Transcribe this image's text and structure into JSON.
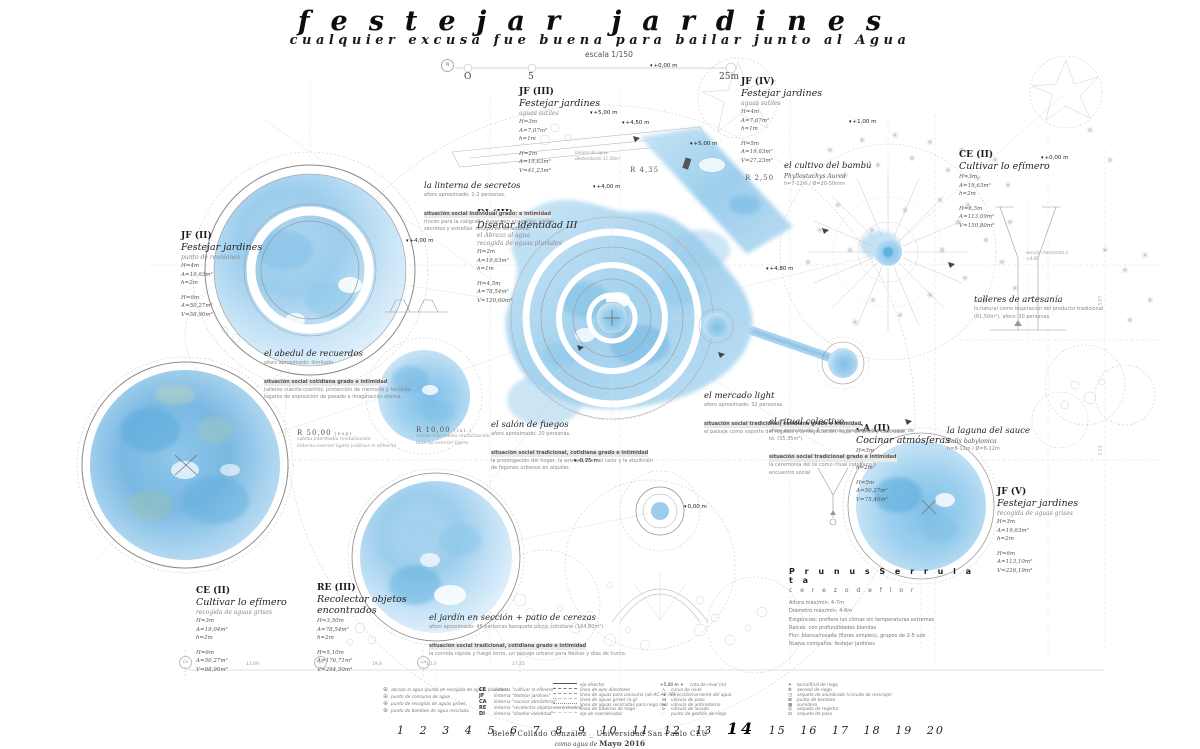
{
  "glyphs": {
    "level": "▾",
    "plant": "✳",
    "north": "N",
    "circle_plus": "⊕"
  },
  "header": {
    "title": "festejar jardines",
    "subtitle": "cualquier excusa fue buena para bailar junto al Agua",
    "scale_label": "escala 1/150",
    "scale_ticks": [
      "O",
      "5",
      "25m"
    ]
  },
  "blocks": {
    "jf2": {
      "code": "JF (II)",
      "title": "Festejar jardines",
      "sub": "punto de reuniones",
      "stats1": [
        "H=4m",
        "A=19,63m²",
        "h=2m"
      ],
      "stats2": [
        "H=6m",
        "A=50,27m²",
        "V=58,90m³"
      ]
    },
    "jf3": {
      "code": "JF (III)",
      "title": "Festejar jardines",
      "sub": "aguas sutiles",
      "stats1": [
        "H=3m",
        "A=7,07m²",
        "h=1m"
      ],
      "stats2": [
        "H=2m",
        "A=19,63m²",
        "V=41,23m³"
      ],
      "note": "lámina de agua desbordante 31,50m²"
    },
    "jf4": {
      "code": "JF (IV)",
      "title": "Festejar jardines",
      "sub": "aguas sutiles",
      "stats1": [
        "H=4m",
        "A=7,07m²",
        "h=1m"
      ],
      "stats2": [
        "H=5m",
        "A=19,63m²",
        "V=27,23m³"
      ]
    },
    "jf5": {
      "code": "JF (V)",
      "title": "Festejar jardines",
      "sub": "recogida de aguas grises",
      "stats1": [
        "H=3m",
        "A=19,63m²",
        "h=2m"
      ],
      "stats2": [
        "H=6m",
        "A=113,10m²",
        "V=226,19m³"
      ]
    },
    "ce2_top": {
      "code": "CE (II)",
      "title": "Cultivar lo efímero",
      "stats1": [
        "H=3m",
        "A=19,63m²",
        "h=2m"
      ],
      "stats2": [
        "H=6,5m",
        "A=113,09m²",
        "V=150,80m³"
      ],
      "note": "sección horizontal a +4,00"
    },
    "ce2_bottom": {
      "code": "CE (II)",
      "title": "Cultivar lo efímero",
      "sub": "recogida de aguas grises",
      "stats1": [
        "H=3m",
        "A=19,04m²",
        "h=2m"
      ],
      "stats2": [
        "H=6m",
        "A=50,27m²",
        "V=88,90m³"
      ]
    },
    "re3": {
      "code": "RE (III)",
      "title": "Recolectar objetos encontrados",
      "stats1": [
        "H=3,50m",
        "A=78,54m²",
        "h=2m"
      ],
      "stats2": [
        "H=5,10m",
        "A=176,71m²",
        "V=294,50m³"
      ]
    },
    "di3": {
      "code": "DI (III)",
      "title": "Diseñar identidad III",
      "sub": "el Abrazo al agua",
      "sub2": "recogida de aguas pluviales",
      "stats1": [
        "H=2m",
        "A=19,63m²",
        "h=1m"
      ],
      "stats2": [
        "H=4,5m",
        "A=78,54m²",
        "V=120,00m³"
      ]
    },
    "ca2": {
      "code": "CA (II)",
      "title": "Cocinar atmósferas",
      "stats1": [
        "H=3m",
        "A=19,63m²",
        "h=2m"
      ],
      "stats2": [
        "H=5m",
        "A=50,27m²",
        "V=75,40m³"
      ]
    }
  },
  "notes": {
    "linterna": {
      "title": "la linterna de secretos",
      "lines": [
        "aforo aproximado: 1-2 personas.",
        "situación social individual grado: e intimidad",
        "rincón para la caligrafía, jugar con acuarelas, contar",
        "secretos y estrellas. refugio de soñadores."
      ]
    },
    "abedul": {
      "title": "el abedul de recuerdos",
      "lines": [
        "aforo aproximado: ilimitado",
        "situación social cotidiana grado e intimidad",
        "talleres cuenta-cuentos, protección de memoria y fantasía.",
        "lugares de exposición de pasado e imaginación eterna."
      ]
    },
    "salon": {
      "title": "el salón de fuegos",
      "lines": [
        "aforo aproximado: 20 personas.",
        "situación social tradicional, cotidiana grado e intimidad",
        "la prolongación del hogar, la asistencia en el calor y la ebullición",
        "de fogones urbanos en alquiler."
      ]
    },
    "mercado": {
      "title": "el mercado light",
      "lines": [
        "aforo aproximado: 32 personas.",
        "situación social tradicional, cotidiana grado e intimidad",
        "el paisaje como soporte del regateo y la negociación, lugar de artes y destrezas."
      ]
    },
    "ritual": {
      "title": "el ritual colectivo",
      "lines": [
        "aforo aproximado: 8 personas descalzándose en vapor de té. (35,35m²)",
        "situación social tradicional grado e intimidad",
        "la ceremonia del té como ritual cotidiano y",
        "encuentro social"
      ]
    },
    "talleres": {
      "title": "talleres de artesanía",
      "lines": [
        "lo natural como inspiración del producto tradicional",
        "(61,50m²), aforo: 20 personas"
      ]
    },
    "bambu": {
      "title": "el cultivo del bambú",
      "lines": [
        "Phyllostachys Aurea",
        "h=7-12m / Ø=20-50mm"
      ]
    },
    "laguna": {
      "title": "la laguna del sauce",
      "lines": [
        "Salix babylonica",
        "h=8-12m / Ø=8-12m"
      ]
    },
    "jardin": {
      "title": "el jardín en sección + patio de cerezas",
      "lines": [
        "aforo aproximado: 48 personas banquete picnic cotidiano (164,80m²)",
        "situación social tradicional, cotidiana grado e intimidad",
        "la comida rápida y fuego lento, un paisaje urbano para fiestas y días de humo."
      ]
    }
  },
  "prunus": {
    "title": "P r u n u s   S e r r u l a t a",
    "sub": "c e r e z o   d e   f l o r",
    "lines": [
      "Altura máx/mín: 4-7m",
      "Diámetro máx/mín: 4-6m",
      "Exigencias: prefiere los climas sin temperaturas extremas",
      "Raíces: con profundidades blandas",
      "Flor: blanca/rosada (flores simples), grupos de 2-5 uds",
      "Nueva compañía: festejar jardines"
    ]
  },
  "radii": {
    "r50": {
      "label": "R 50,00",
      "sub": "(esp)",
      "lines": [
        "cabina intermedia revitalización",
        "linterna exterior ligera (cultivar lo efímero)"
      ]
    },
    "r10": {
      "label": "R 10,00",
      "sub": "(int.)",
      "lines": [
        "cabina intermedia revitalización",
        "linterna exterior ligera"
      ]
    },
    "r435": "R 4,35",
    "r250": "R 2,50"
  },
  "levels": [
    "+0,00 m",
    "+5,00 m",
    "+4,50 m",
    "+4,00 m",
    "+5,00 m",
    "+1,00 m",
    "+0,00 m",
    "+4,80 m",
    "-0,75 m",
    "0,00 m",
    "+4,00 m"
  ],
  "dim_bottom": {
    "codes": [
      "F·6",
      "C·6",
      "A·6"
    ],
    "values": [
      "13,09",
      "19,4",
      "1,13",
      "17,25"
    ]
  },
  "vnums": [
    "1,03",
    "5,07"
  ],
  "legend": {
    "points": [
      "abrazo al agua (punto de recogida de aguas pluviales)",
      "punto de consumo de agua",
      "punto de recogida de aguas grises",
      "punto de bombeo de agua reciclada"
    ],
    "codes": [
      {
        "code": "CE",
        "label": "linterna \"cultivar lo efímero\""
      },
      {
        "code": "JF",
        "label": "linterna \"festejar jardines\""
      },
      {
        "code": "CA",
        "label": "linterna \"cocinar atmósferas\""
      },
      {
        "code": "RE",
        "label": "linterna \"recolectar objetos encontrados\""
      },
      {
        "code": "DI",
        "label": "linterna \"diseñar identidad\""
      }
    ],
    "lines": [
      {
        "style": "solid",
        "label": "eje director"
      },
      {
        "style": "dashdot",
        "label": "línea de ejes directores"
      },
      {
        "style": "dash",
        "label": "línea de aguas para consumo (ab-AC-AE-AF)"
      },
      {
        "style": "dash2",
        "label": "línea de aguas grises (a-g)"
      },
      {
        "style": "dots",
        "label": "línea de aguas recicladas para riego (ua)"
      },
      {
        "style": "dash3",
        "label": "línea de tuberías de riego"
      },
      {
        "style": "dashdot2",
        "label": "eje de coordenadas"
      }
    ],
    "hydro": [
      {
        "icon": "▾",
        "pre": "+5,00 m",
        "label": "cota de nivel (m)"
      },
      {
        "icon": "∿",
        "label": "curva de nivel"
      },
      {
        "icon": "→",
        "label": "dirección/corriente del agua"
      },
      {
        "icon": "⋈",
        "label": "válvula de paso"
      },
      {
        "icon": "⋉",
        "label": "válvula de antirretorno"
      },
      {
        "icon": "⊳",
        "label": "válvula de lavado"
      },
      {
        "icon": "·",
        "label": "punto de gestión de riego"
      }
    ],
    "arq": [
      {
        "icon": "✦",
        "label": "toma/final de riego"
      },
      {
        "icon": "✻",
        "label": "aerosol de riego"
      },
      {
        "icon": "◫",
        "label": "arqueta de alumbrado (circuito de reciclaje)"
      },
      {
        "icon": "⊠",
        "label": "punto de bombeo"
      },
      {
        "icon": "▩",
        "label": "sumidero"
      },
      {
        "icon": "◎",
        "label": "arqueta de registro"
      },
      {
        "icon": "⊡",
        "label": "arqueta de paso"
      }
    ]
  },
  "axis_numbers": [
    "1",
    "2",
    "3",
    "4",
    "5",
    "6",
    "7",
    "8",
    "9",
    "10",
    "11",
    "12",
    "13",
    "14",
    "15",
    "16",
    "17",
    "18",
    "19",
    "20"
  ],
  "credits": {
    "line1": "Belén Collado González _ Universidad San Pablo CEU",
    "line2_pre": "como agua de",
    "line2_bold": "Mayo 2016"
  }
}
